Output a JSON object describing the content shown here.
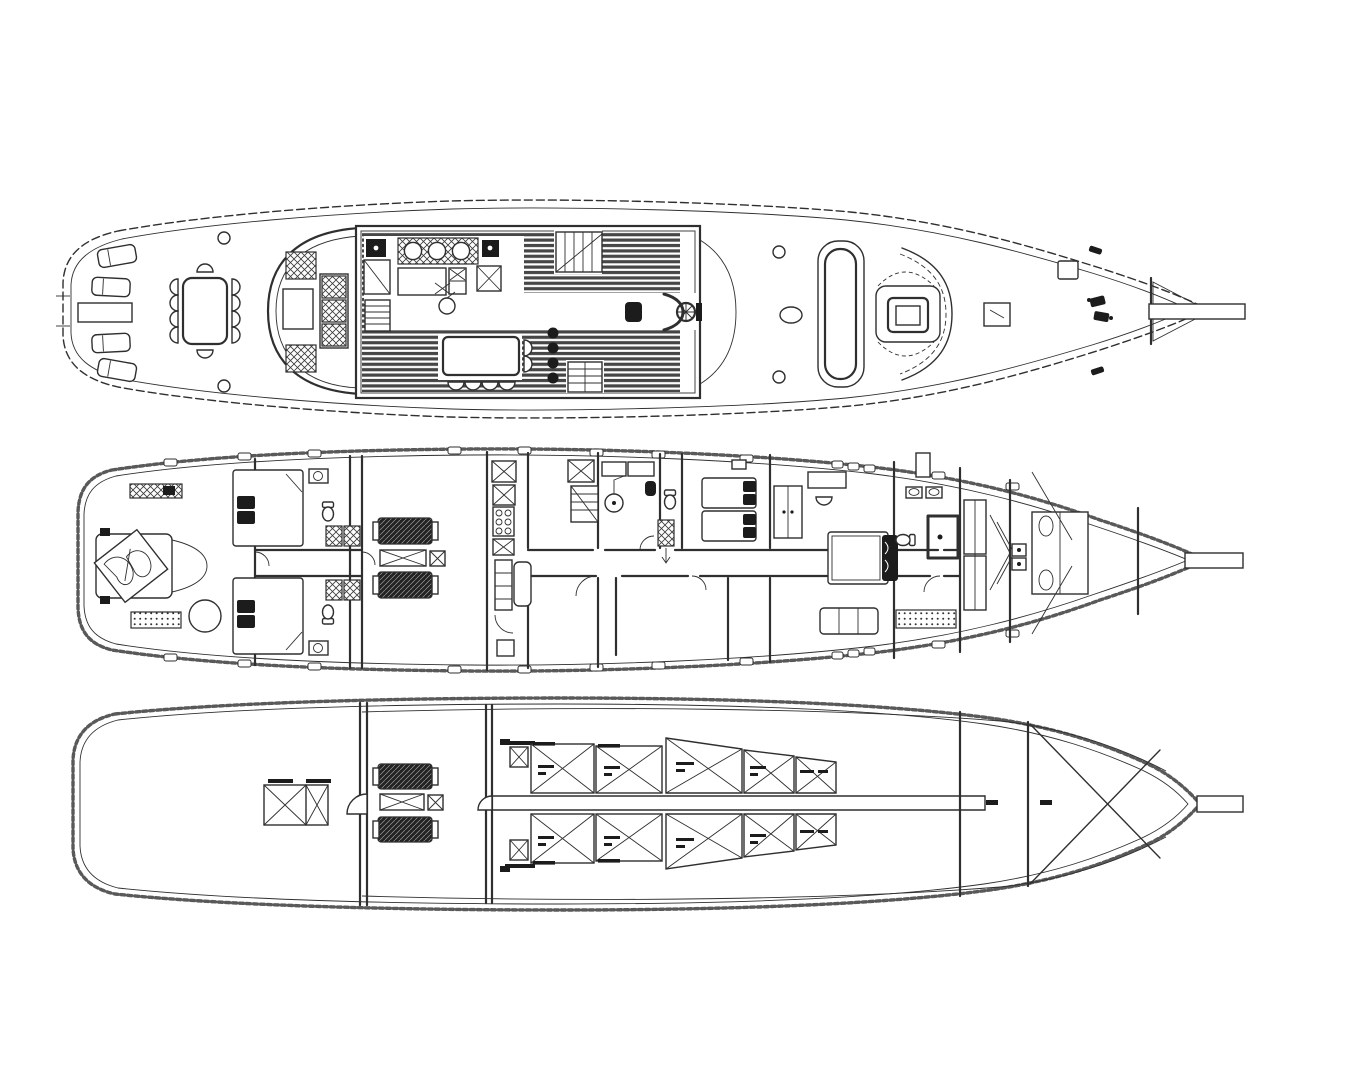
{
  "sheet": {
    "type": "yacht-deck-plans",
    "views": 3,
    "background": "#ffffff"
  },
  "colors": {
    "paper": "#ffffff",
    "ink": "#2f2f2f",
    "dark": "#1c1c1c"
  },
  "decks": [
    {
      "id": "main-deck",
      "label": "main-deck-plan",
      "position": "top",
      "sun_loungers": 4,
      "aft_dining_chairs": 10,
      "cockpit_seats": 2,
      "bench_cushions": 3,
      "salon_bar_stools": 4,
      "staircases": 3,
      "galley_burners": 3,
      "deck_hatches": 2
    },
    {
      "id": "lower-deck",
      "label": "lower-deck-plan",
      "position": "middle",
      "guest_cabins": 4,
      "crew_berths": 2,
      "bathrooms": 5,
      "engine_room_gensets": 2,
      "wardrobes": 3
    },
    {
      "id": "tank-deck",
      "label": "tank-deck-plan",
      "position": "bottom",
      "port_tanks": 5,
      "starboard_tanks": 5,
      "gensets": 2,
      "storage_crates": 2,
      "forepeak_braces": 2
    }
  ]
}
